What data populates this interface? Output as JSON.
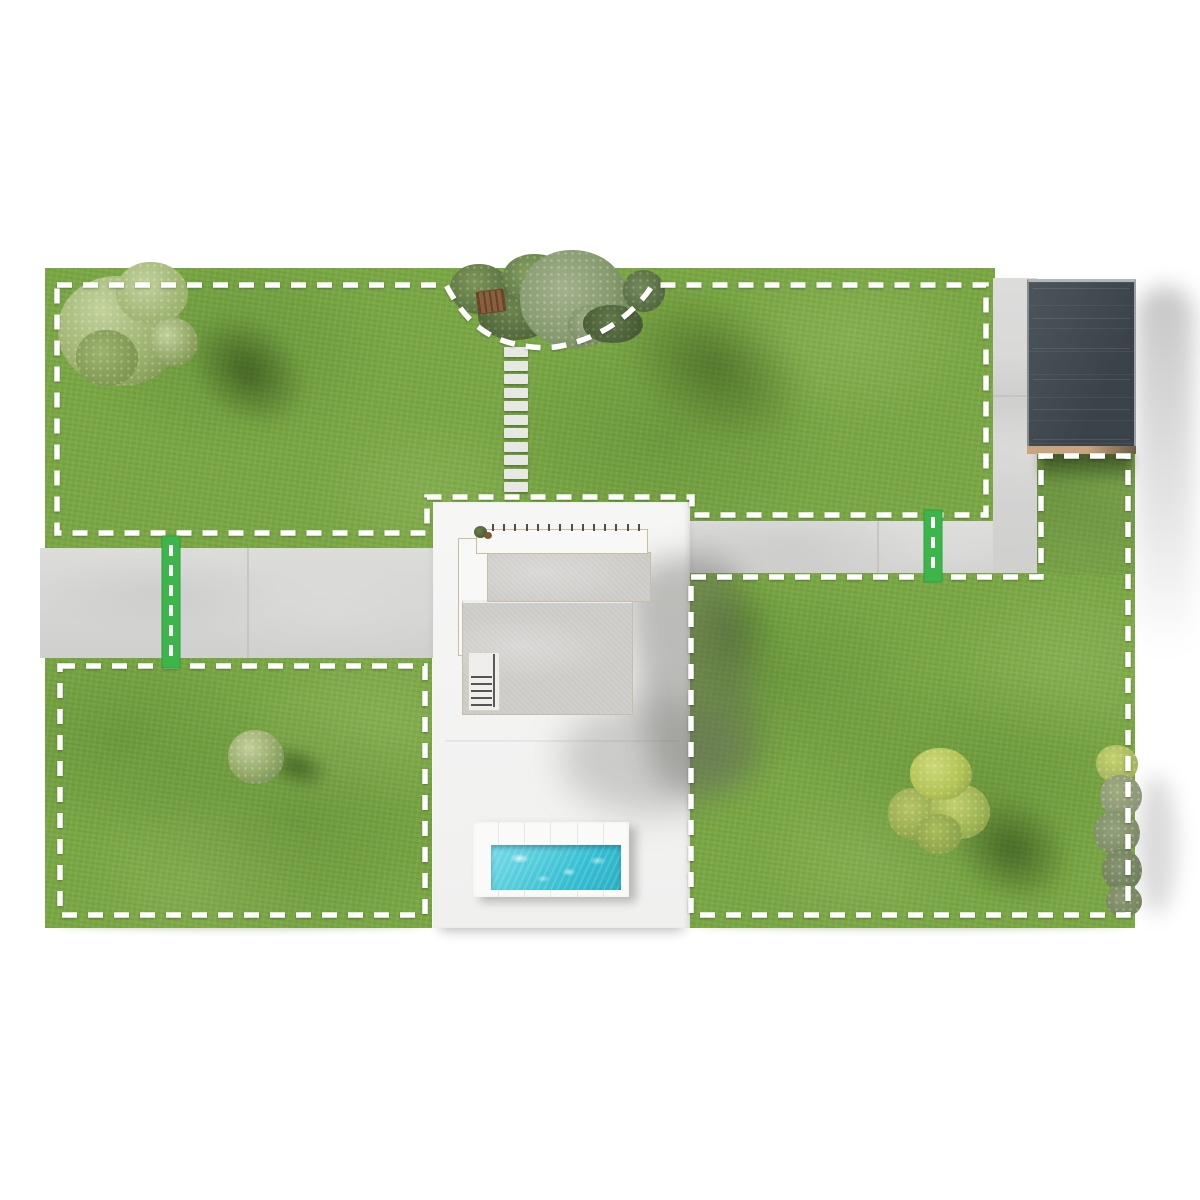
{
  "scene": {
    "kind": "aerial-lawn-zone-map",
    "zones": [
      {
        "id": "top-lawn",
        "boundary_style": "white-dashed",
        "contains": [
          "large-tree",
          "garden-bed-cutout",
          "stepping-stone-path"
        ]
      },
      {
        "id": "bottom-left-lawn",
        "boundary_style": "white-dashed",
        "contains": [
          "round-bush"
        ]
      },
      {
        "id": "right-lawn",
        "boundary_style": "white-dashed",
        "contains": [
          "lime-trees",
          "hedge-row"
        ]
      }
    ],
    "connectors": [
      {
        "id": "left-path-crossing",
        "style": "green-with-white-dashes"
      },
      {
        "id": "right-path-crossing",
        "style": "green-with-white-dashes"
      }
    ],
    "objects": {
      "house": "modern-flat-roof-house-with-patio",
      "pool": "rectangular-pool-with-deck",
      "garage": "dark-panel-roof-carport",
      "paths": [
        "left-walkway",
        "right-walkway",
        "vertical-driveway"
      ],
      "garden": [
        "olive-tree",
        "shrubs",
        "wooden-bench"
      ],
      "trees": [
        "large-tree-top-left",
        "round-bush-bottom-left",
        "lime-trees-bottom-right",
        "hedge-right-edge"
      ]
    }
  },
  "colors": {
    "background": "#ffffff",
    "grass": "#7aa844",
    "path": "#d8d8d7",
    "path_seam": "#bdbdbc",
    "boundary_dash": "#ffffff",
    "connector_green": "#3cb54a",
    "patio": "#f4f4f3",
    "roof_gray": "#d0cfcc",
    "roof_trim": "#c9bda6",
    "roof_white": "#f8f8f6",
    "garage_dark": "#3a424a",
    "garage_light": "#4c545c",
    "garage_base_wood": "#c8a57e",
    "pool_water": "#35bfd2",
    "pool_water_light": "#79dce6",
    "pool_deck": "#fafaf9",
    "stone": "#e7e8e3",
    "canopy_light": "#c2d29b",
    "canopy_mid": "#9cb26f",
    "canopy_dark": "#7e9552",
    "olive_light": "#a3b28c",
    "olive_dark": "#6d8258",
    "lime": "#b3c356",
    "hedge_gray": "#8a9577",
    "bench_wood": "#8a5f3b",
    "shadow_green": "rgba(25,45,10,0.5)"
  },
  "counts": {
    "stepping_stones": 11,
    "pergola_beams": 14,
    "stair_steps": 5,
    "pool_deck_seams": 5,
    "garage_panels": 6
  }
}
